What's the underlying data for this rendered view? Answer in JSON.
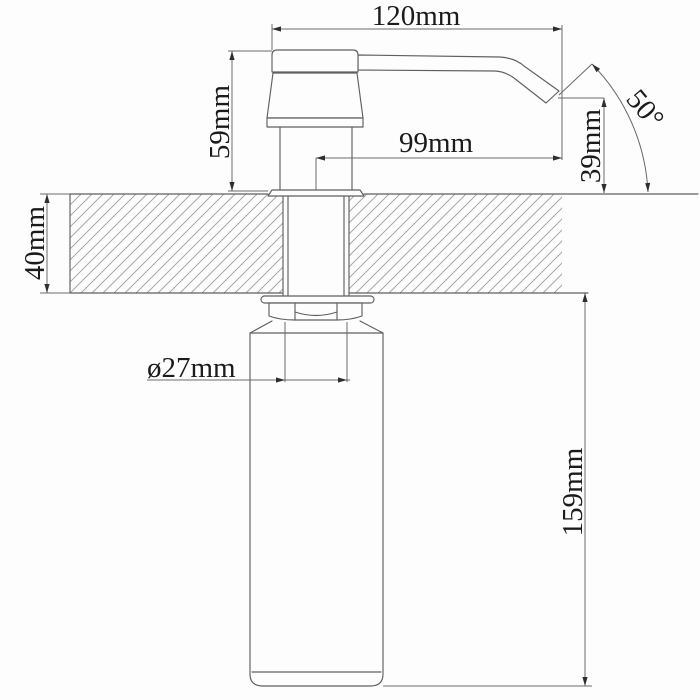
{
  "drawing": {
    "subject": "soap dispenser installation dimension drawing",
    "labels": {
      "overall_reach": "120mm",
      "head_height": "59mm",
      "spout_reach_from_center": "99mm",
      "spout_angle": "50°",
      "spout_tip_to_counter": "39mm",
      "counter_thickness": "40mm",
      "shank_diameter": "ø27mm",
      "under_counter_length": "159mm"
    },
    "colors": {
      "background": "#fdfdfd",
      "outline": "#606060",
      "dimension_lines": "#6a6a6a",
      "hatch": "#a8a8a8",
      "text": "#1b1b1b"
    }
  }
}
